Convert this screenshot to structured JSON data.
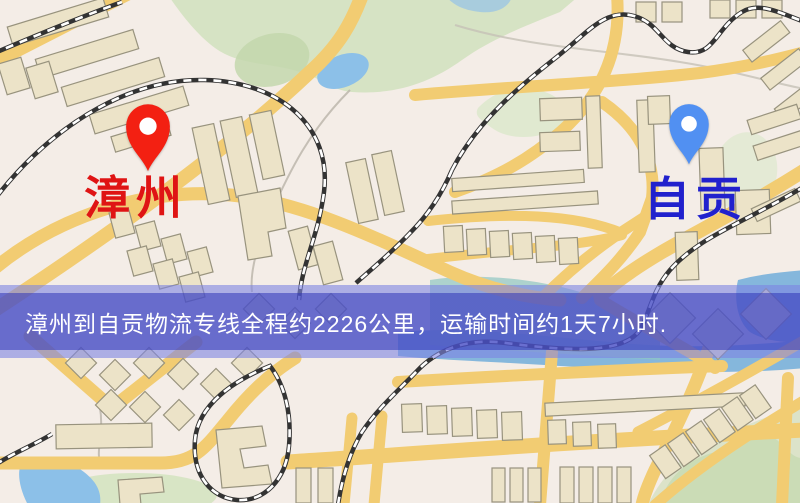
{
  "route_banner": {
    "text": "漳州到自贡物流专线全程约2226公里，运输时间约1天7小时.",
    "text_color": "#ffffff",
    "background_color": "#494fc6"
  },
  "markers": {
    "origin": {
      "name": "漳州",
      "pin_color": "#f32012",
      "label_color": "#df1414"
    },
    "destination": {
      "name": "自贡",
      "pin_color": "#5190f2",
      "label_color": "#2121cd"
    }
  },
  "map_colors": {
    "base": "#f4ede7",
    "road_yellow": "#f2cc72",
    "building_tan": "#ece3c8",
    "park_green": "#d6e3c4",
    "water_blue": "#8cc0e8",
    "railway_dark": "#333333"
  }
}
